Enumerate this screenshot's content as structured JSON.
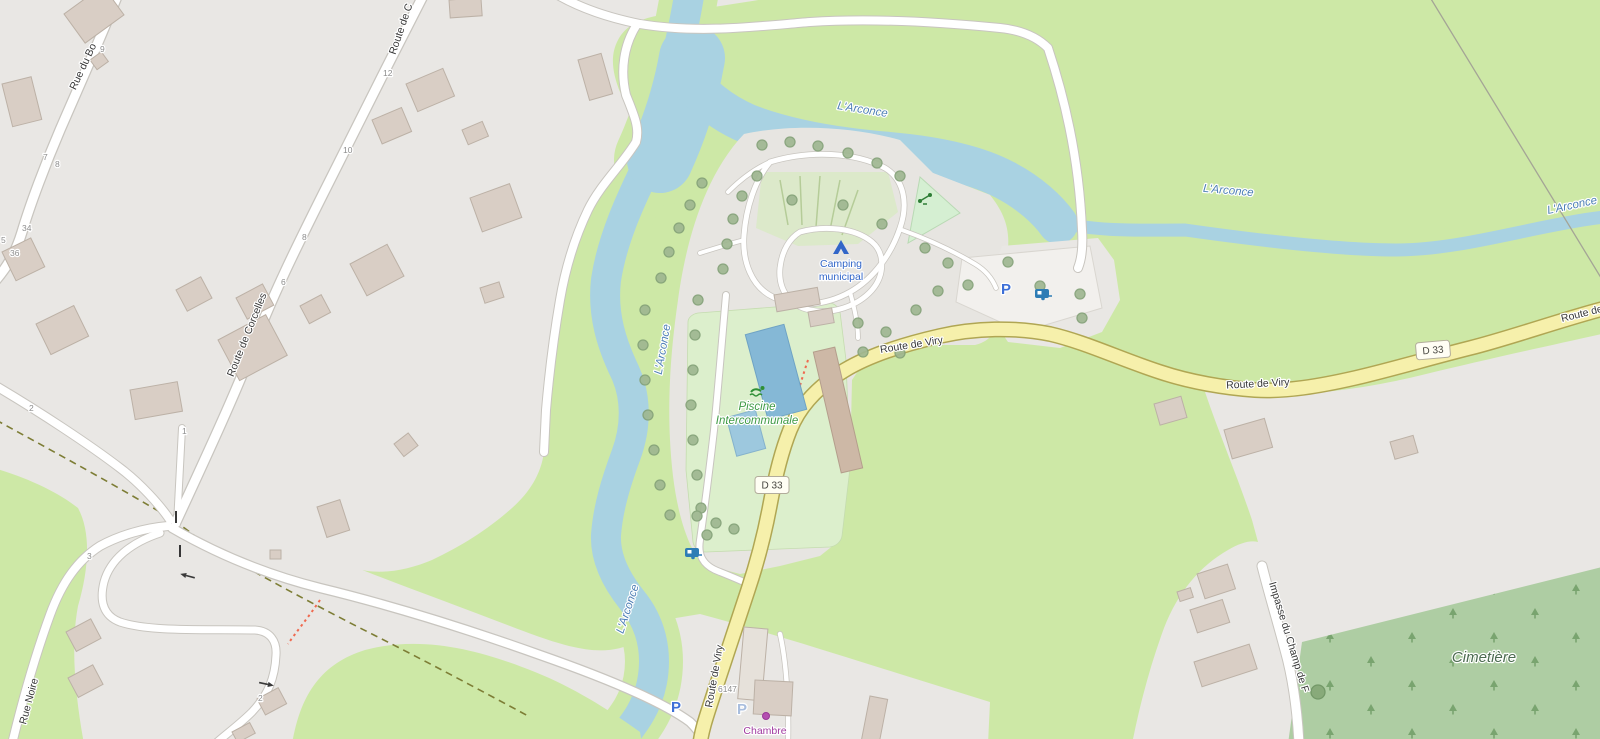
{
  "map": {
    "colors": {
      "water": "#a9d2e2",
      "meadow": "#cde8a6",
      "residential": "#e9e7e4",
      "road_primary_fill": "#f6f0ab",
      "building": "#d9cec5",
      "cemetery_green": "#aecda3",
      "camping_blue": "#3266c8",
      "leisure_green": "#3f9b45",
      "water_label_blue": "#4d7fb5",
      "tourism_purple": "#a03ba0",
      "parking_blue": "#3d6fd7"
    },
    "water": {
      "river_label": "L'Arconce"
    },
    "streets": {
      "rue_du_bois": "Rue du Bo",
      "route_de_corcelles": "Route de Corcelles",
      "route_de_corcelles_top": "Route de C",
      "rue_noire": "Rue Noire",
      "route_de_viry": "Route de Viry",
      "impasse_du_champ": "Impasse du Champ de F",
      "d33": "D 33"
    },
    "places": {
      "camping_line1": "Camping",
      "camping_line2": "municipal",
      "piscine_line1": "Piscine",
      "piscine_line2": "Intercommunale",
      "cimetiere": "Cimetière",
      "chambre": "Chambre",
      "parking": "P"
    },
    "house_numbers": {
      "n9": "9",
      "n7": "7",
      "n8a": "8",
      "n34": "34",
      "n5": "5",
      "n36": "36",
      "n2a": "2",
      "n3": "3",
      "n1": "1",
      "n2b": "2",
      "n12": "12",
      "n10": "10",
      "n8b": "8",
      "n6": "6",
      "n6147": "6147"
    }
  }
}
